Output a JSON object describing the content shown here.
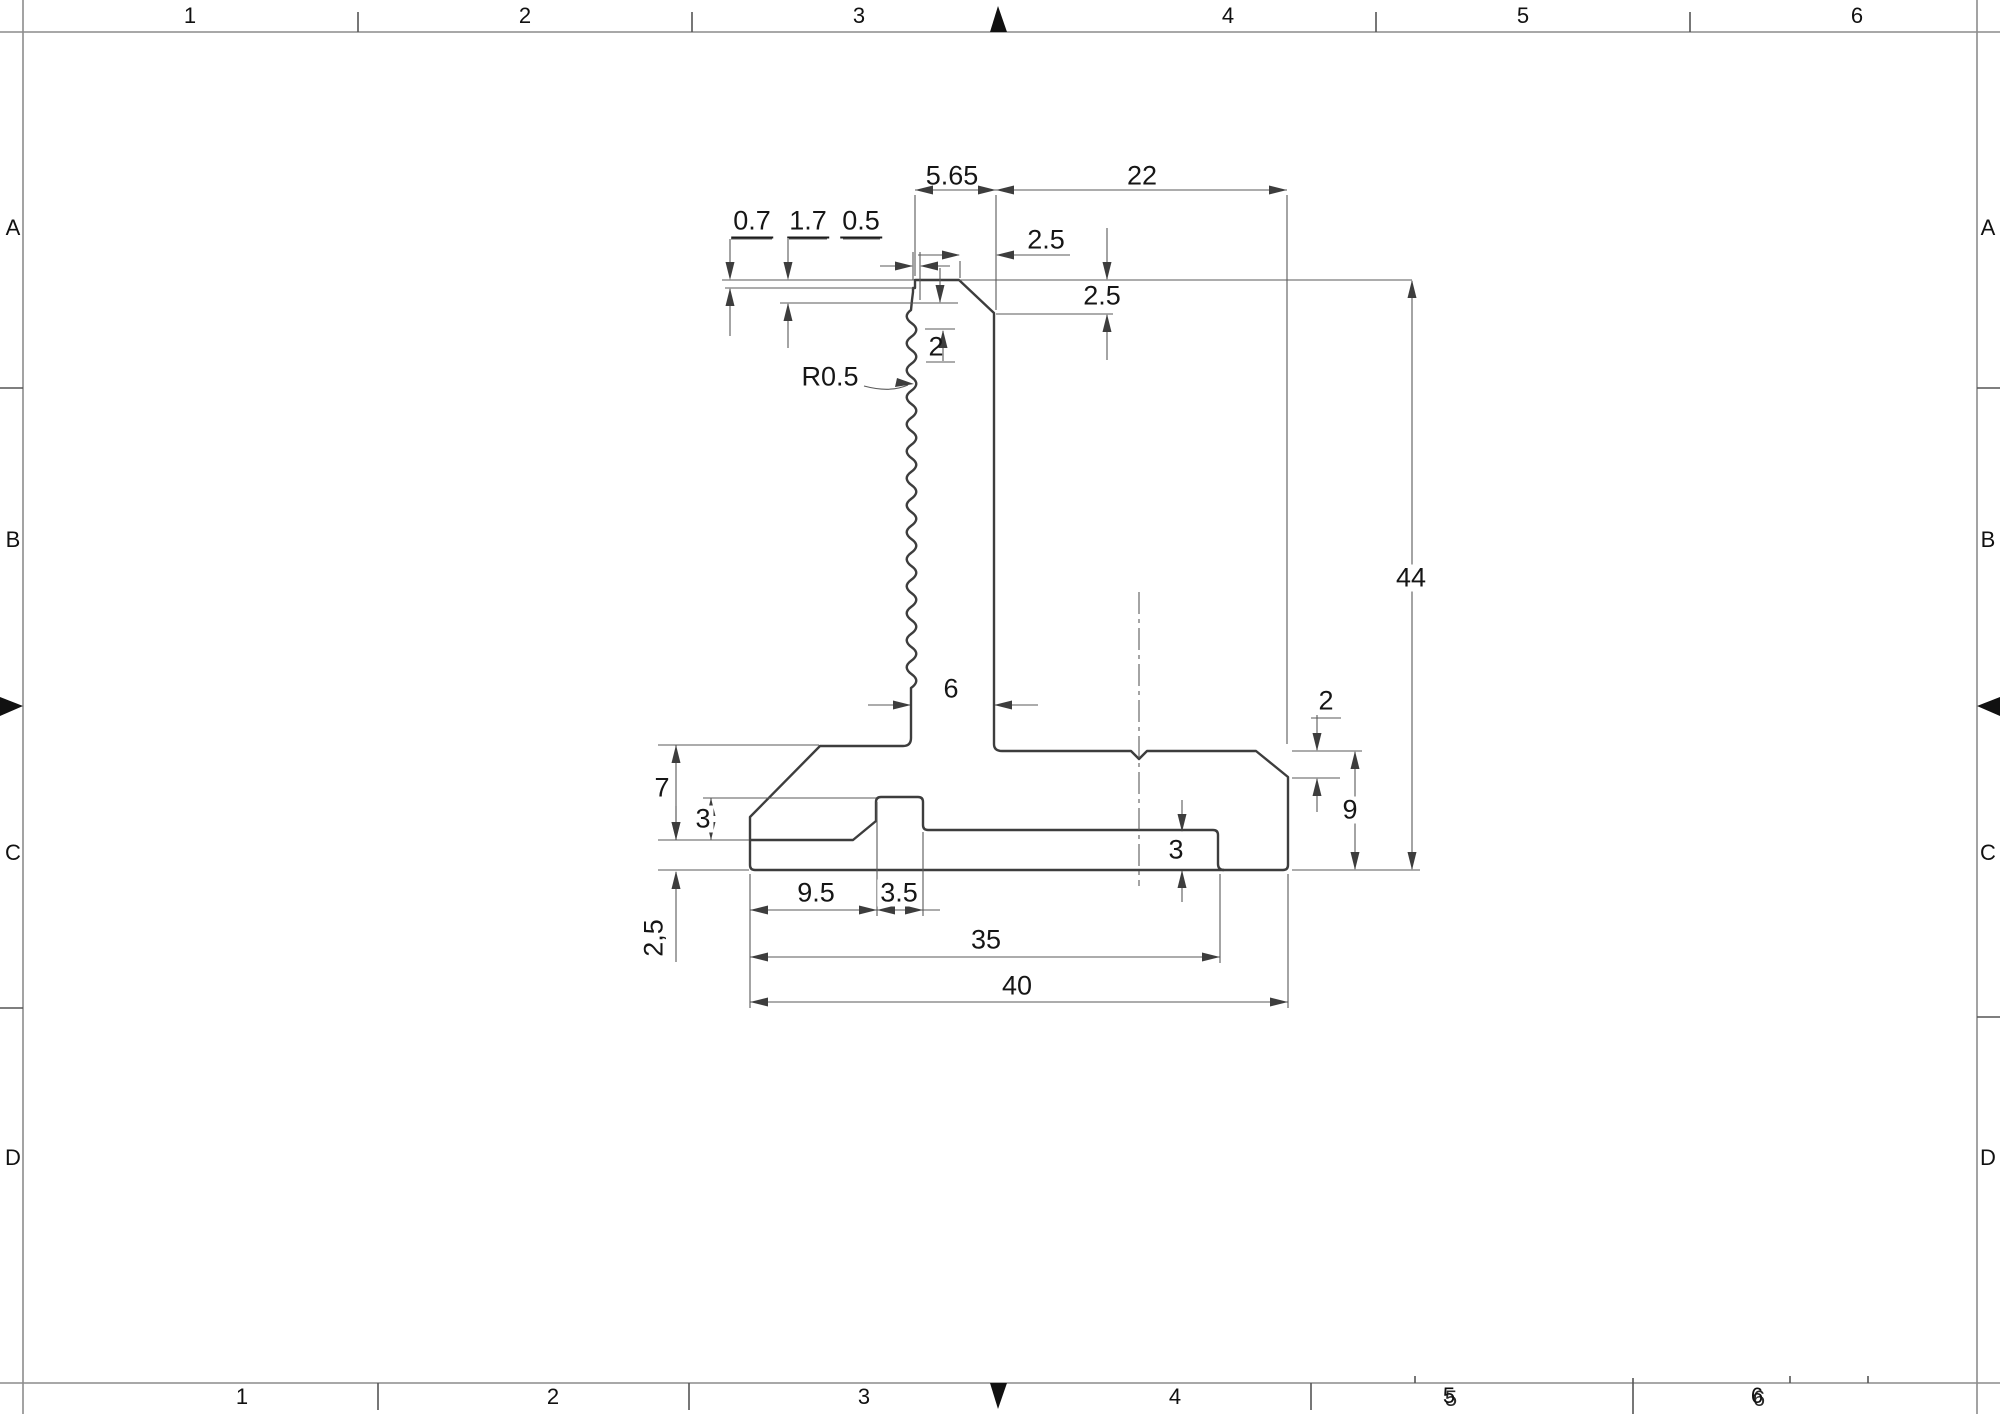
{
  "sheet": {
    "type": "technical-drawing",
    "colors": {
      "part_line": "#3d3d3d",
      "thin_line": "#5a5a5a",
      "frame": "#8c8c8c",
      "text": "#161616"
    }
  },
  "border": {
    "top_zones": [
      "1",
      "2",
      "3",
      "4",
      "5",
      "6"
    ],
    "bottom_zones": [
      "1",
      "2",
      "3",
      "4",
      "5",
      "6"
    ],
    "left_rows": [
      "A",
      "B",
      "C",
      "D"
    ],
    "right_rows": [
      "A",
      "B",
      "C",
      "D"
    ]
  },
  "dims": {
    "head_top_width": "5.65",
    "top_right_width": "22",
    "step_0_7": "0.7",
    "step_1_7": "1.7",
    "serration_offset": "0.5",
    "top_chamfer_width": "2.5",
    "top_chamfer_depth": "2.5",
    "serration_pitch": "2",
    "serration_radius": "R0.5",
    "stem_width": "6",
    "overall_height": "44",
    "left_shoulder_height": "7",
    "left_groove_step": "3",
    "left_recess_depth": "2,5",
    "foot_offset": "9.5",
    "slot_width": "3.5",
    "inner_width": "35",
    "base_width": "40",
    "right_chamfer_height": "2",
    "base_right_height": "9",
    "right_groove_depth": "3"
  }
}
